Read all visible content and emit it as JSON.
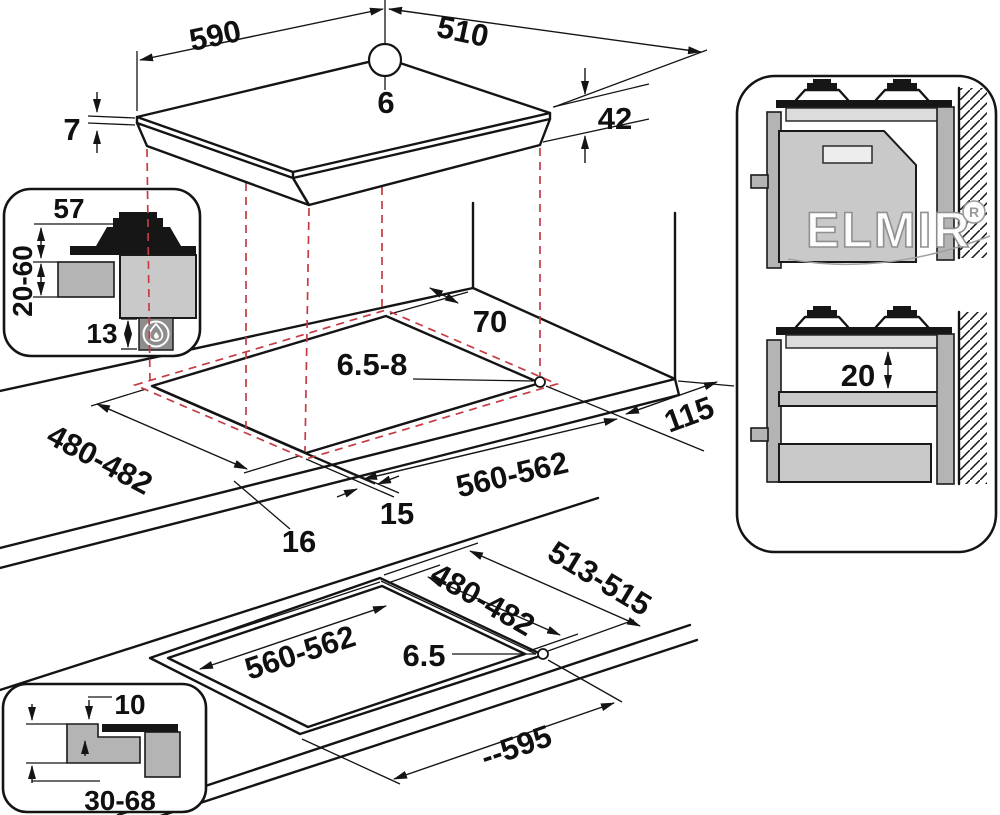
{
  "colors": {
    "line": "#141414",
    "dashed_red": "#c53b44",
    "gray_light": "#c9c9c9",
    "gray_mid": "#b4b4b4",
    "watermark_fill": "#ffffff",
    "watermark_stroke": "#8f8f8f"
  },
  "top_view": {
    "width_mm": "590",
    "depth_mm": "510",
    "hole_dia": "6",
    "glass_thickness": "7",
    "overall_height": "42"
  },
  "section_inset": {
    "burner_height": "57",
    "worktop_thickness": "20-60",
    "clearance_below": "13"
  },
  "cutout_view": {
    "rear_clearance": "70",
    "fixing_hole_dia": "6.5-8",
    "right_clearance": "115",
    "cutout_depth": "480-482",
    "cutout_width": "560-562",
    "edge_margin_side": "15",
    "edge_margin_front": "16"
  },
  "side_view_panel": {
    "air_gap": "20"
  },
  "flush_view": {
    "recess_depth": "513-515",
    "cutout_depth": "480-482",
    "cutout_width": "560-562",
    "fixing_hole_dia": "6.5",
    "recess_width": "--595"
  },
  "flush_inset": {
    "recess_lip_depth": "10",
    "worktop_thickness": "30-68"
  },
  "watermark": {
    "brand": "ELMIR",
    "registered_mark": "R"
  }
}
